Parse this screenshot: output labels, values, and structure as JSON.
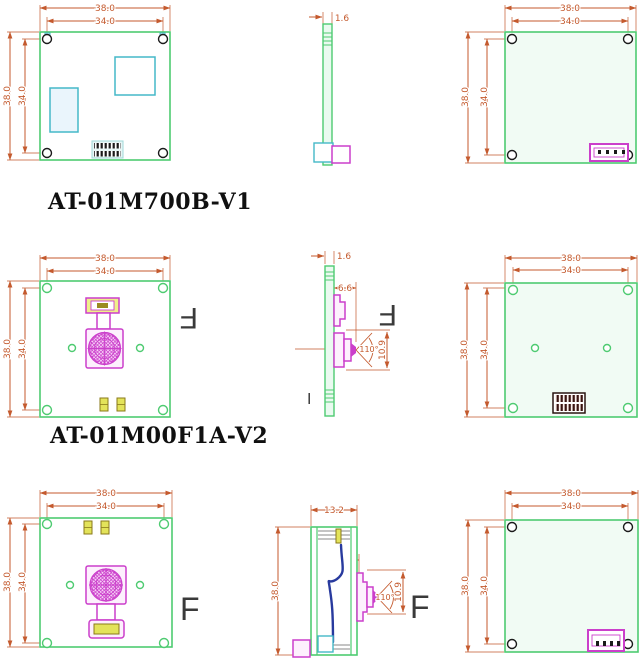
{
  "colors": {
    "dim": "#c45a2e",
    "green": "#4ecb71",
    "cyan": "#45b8c8",
    "magenta": "#cb3fcb",
    "yellow": "#e3e35a",
    "cable": "#283a9e",
    "dark": "#1a1a1a",
    "marker": "#3a3a3a",
    "text": "#101010"
  },
  "r1": {
    "label": "AT-01M700B-V1",
    "f": {
      "w1": "38.0",
      "w2": "34.0",
      "h1": "38.0",
      "h2": "34.0"
    },
    "s": {
      "t": "1.6"
    },
    "b": {
      "w1": "38.0",
      "w2": "34.0",
      "h1": "38.0",
      "h2": "34.0"
    }
  },
  "r2": {
    "label": "AT-01M00F1A-V2",
    "f": {
      "w1": "38.0",
      "w2": "34.0",
      "h1": "38.0",
      "h2": "34.0",
      "marker": "F"
    },
    "s": {
      "t": "1.6",
      "lens": "6.6",
      "angle": "110°",
      "h": "10.9",
      "marker": "F",
      "tick": "I"
    },
    "b": {
      "w1": "38.0",
      "w2": "34.0",
      "h1": "38.0",
      "h2": "34.0"
    }
  },
  "r3": {
    "f": {
      "w1": "38.0",
      "w2": "34.0",
      "h1": "38.0",
      "h2": "34.0",
      "lw": "10.8",
      "lh": "10.8",
      "marker": "F"
    },
    "s": {
      "w": "13.2",
      "h": "38.0",
      "lens": "6.6",
      "angle": "110°",
      "mh": "10.9",
      "marker": "F"
    },
    "b": {
      "w1": "38.0",
      "w2": "34.0",
      "h1": "38.0",
      "h2": "34.0"
    }
  }
}
